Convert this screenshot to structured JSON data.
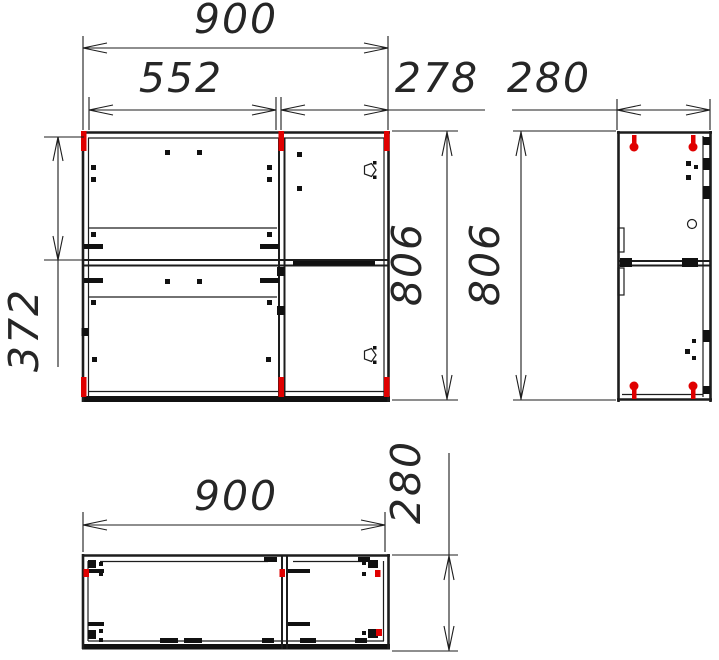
{
  "drawing": {
    "type": "cabinet-assembly-technical-drawing",
    "views": {
      "front": "front-view",
      "side": "side-view",
      "plan": "bottom-view"
    }
  },
  "colors": {
    "line": "#1d1d1d",
    "fastener_red": "#e00000",
    "background": "#ffffff"
  },
  "dimensions": {
    "front_total_width": "900",
    "front_left_section_width": "552",
    "front_right_section_width": "278",
    "side_depth": "280",
    "front_height": "806",
    "side_height": "806",
    "front_top_to_divider": "372",
    "plan_width": "900",
    "plan_depth": "280"
  }
}
